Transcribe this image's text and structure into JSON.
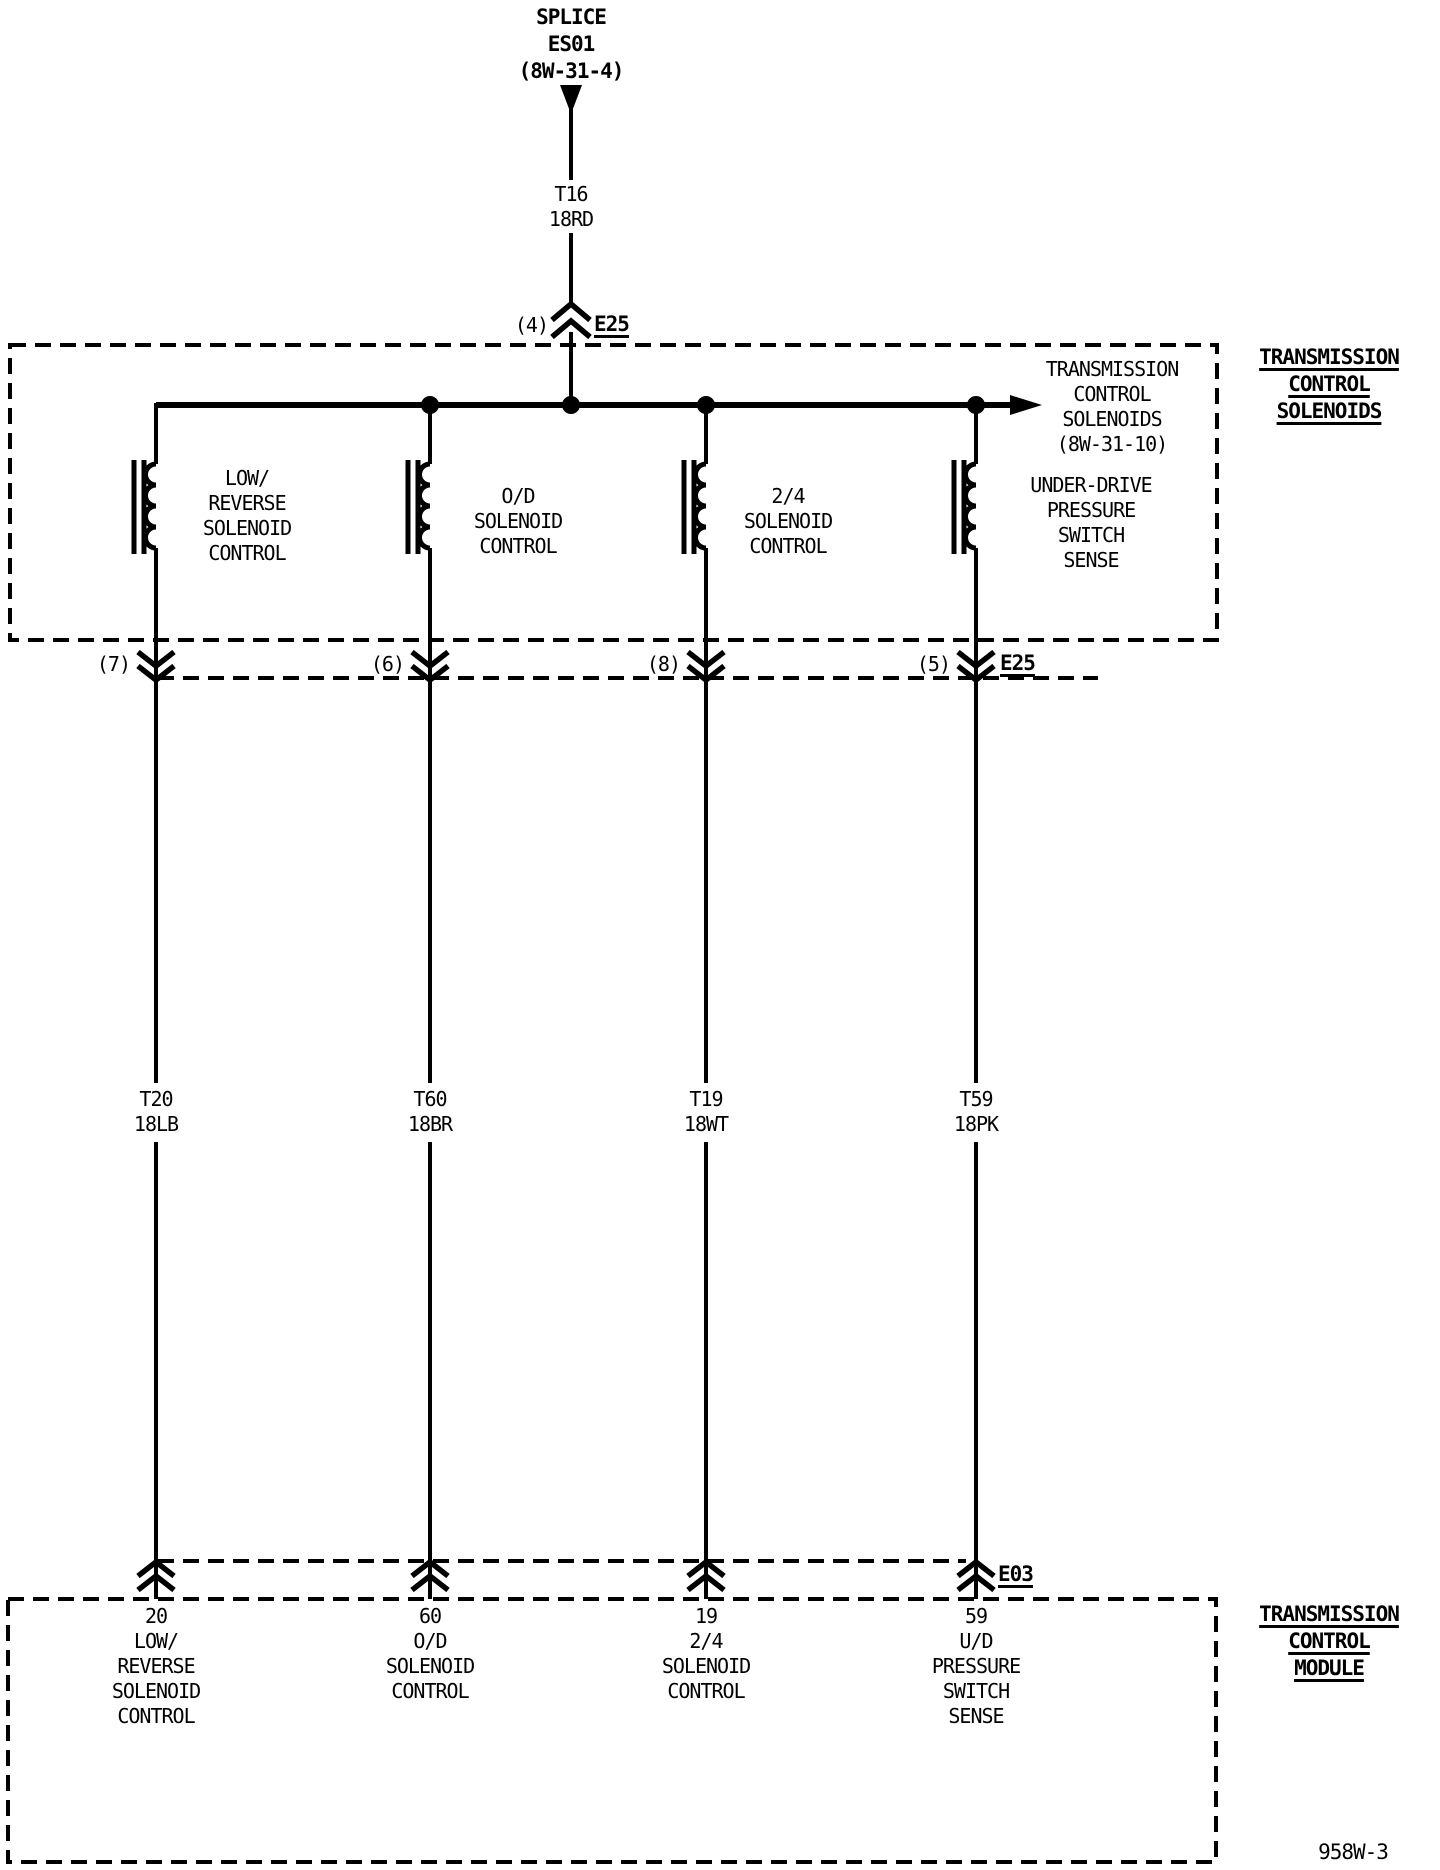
{
  "colors": {
    "ink": "#000000",
    "paper": "#ffffff"
  },
  "splice": {
    "label": "SPLICE\nES01\n(8W-31-4)"
  },
  "feed_wire": {
    "label": "T16\n18RD"
  },
  "e25_top": {
    "pin": "(4)",
    "name": "E25"
  },
  "solenoid_box": {
    "title": "TRANSMISSION\nCONTROL\nSOLENOIDS",
    "offpage_ref": "TRANSMISSION\nCONTROL\nSOLENOIDS\n(8W-31-10)",
    "solenoids": [
      {
        "label": "LOW/\nREVERSE\nSOLENOID\nCONTROL"
      },
      {
        "label": "O/D\nSOLENOID\nCONTROL"
      },
      {
        "label": "2/4\nSOLENOID\nCONTROL"
      },
      {
        "label": "UNDER-DRIVE\nPRESSURE\nSWITCH\nSENSE"
      }
    ]
  },
  "e25_bottom": {
    "name": "E25",
    "pins": [
      {
        "pin": "(7)"
      },
      {
        "pin": "(6)"
      },
      {
        "pin": "(8)"
      },
      {
        "pin": "(5)"
      }
    ]
  },
  "wires": [
    {
      "label": "T20\n18LB"
    },
    {
      "label": "T60\n18BR"
    },
    {
      "label": "T19\n18WT"
    },
    {
      "label": "T59\n18PK"
    }
  ],
  "e03": {
    "name": "E03"
  },
  "tcm_box": {
    "title": "TRANSMISSION\nCONTROL\nMODULE",
    "pins": [
      {
        "label": "20\nLOW/\nREVERSE\nSOLENOID\nCONTROL"
      },
      {
        "label": "60\nO/D\nSOLENOID\nCONTROL"
      },
      {
        "label": "19\n2/4\nSOLENOID\nCONTROL"
      },
      {
        "label": "59\nU/D\nPRESSURE\nSWITCH\nSENSE"
      }
    ]
  },
  "footer": {
    "diagram_ref": "958W-3"
  }
}
